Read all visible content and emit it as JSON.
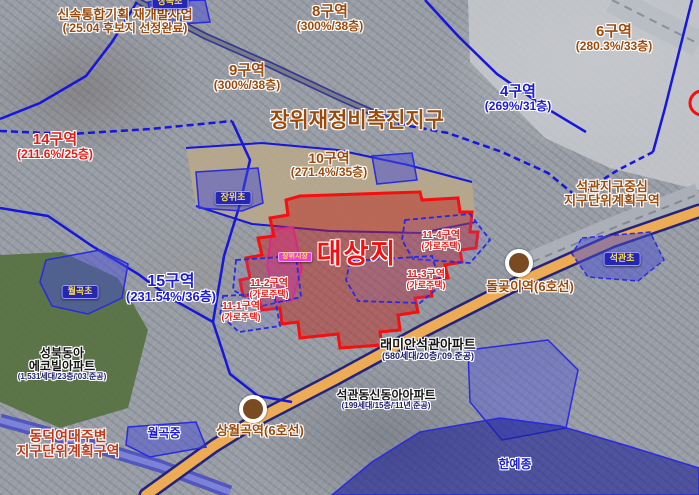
{
  "map": {
    "district_title": "장위재정비촉진지구",
    "colors": {
      "label-brown": "#9c4a0a",
      "label-red": "#e51c15",
      "label-redbrown": "#c0391a",
      "label-blue": "#1b1bd8",
      "label-black": "#141414",
      "label-navy": "#1a1a72",
      "target-red": "#f50f0f",
      "boundary-blue": "#1616dc",
      "road-orange": "#edab55",
      "road-casing": "#23237d",
      "railway-gray": "#b4b8bf",
      "schoolbox-bg": "#2626b4",
      "schoolbox-text": "#ffe14d",
      "market-magenta": "#e83cdc",
      "station-brown": "#7a4b22"
    },
    "labels": [
      {
        "id": "fast-track-note",
        "x": 125,
        "y": 8,
        "cls": "c-brown",
        "lines": [
          {
            "t": "신속통합기획 재개발사업",
            "fs": 13
          },
          {
            "t": "('25.04 후보지 선정완료)",
            "fs": 12
          }
        ]
      },
      {
        "id": "zone-8-label",
        "x": 330,
        "y": 4,
        "cls": "c-brown",
        "lines": [
          {
            "t": "8구역",
            "fs": 15
          },
          {
            "t": "(300%/38층)",
            "fs": 12
          }
        ]
      },
      {
        "id": "zone-9-label",
        "x": 247,
        "y": 63,
        "cls": "c-brown",
        "lines": [
          {
            "t": "9구역",
            "fs": 15
          },
          {
            "t": "(300%/38층)",
            "fs": 12
          }
        ]
      },
      {
        "id": "zone-6-label",
        "x": 614,
        "y": 24,
        "cls": "c-brown",
        "lines": [
          {
            "t": "6구역",
            "fs": 15
          },
          {
            "t": "(280.3%/33층)",
            "fs": 12
          }
        ]
      },
      {
        "id": "zone-4-label",
        "x": 518,
        "y": 84,
        "cls": "c-blue",
        "lines": [
          {
            "t": "4구역",
            "fs": 15
          },
          {
            "t": "(269%/31층)",
            "fs": 12
          }
        ]
      },
      {
        "id": "district-title",
        "x": 357,
        "y": 110,
        "cls": "c-brown",
        "lines": [
          {
            "t": "장위재정비촉진지구",
            "fs": 21
          }
        ]
      },
      {
        "id": "zone-10-label",
        "x": 329,
        "y": 151,
        "cls": "c-brown",
        "lines": [
          {
            "t": "10구역",
            "fs": 14
          },
          {
            "t": "(271.4%/35층)",
            "fs": 12
          }
        ]
      },
      {
        "id": "zone-14-label",
        "x": 55,
        "y": 132,
        "cls": "c-red",
        "lines": [
          {
            "t": "14구역",
            "fs": 15
          },
          {
            "t": "(211.6%/25층)",
            "fs": 12
          }
        ]
      },
      {
        "id": "seokgwan-district-center-label",
        "x": 612,
        "y": 180,
        "cls": "c-brown",
        "lines": [
          {
            "t": "석관지구중심",
            "fs": 13
          },
          {
            "t": "지구단위계획구역",
            "fs": 13
          }
        ]
      },
      {
        "id": "target-site-label",
        "x": 357,
        "y": 240,
        "cls": "c-target",
        "lines": [
          {
            "t": "대상지",
            "fs": 27
          }
        ]
      },
      {
        "id": "zone-11-4-label",
        "x": 441,
        "y": 231,
        "cls": "c-red",
        "lines": [
          {
            "t": "11-4구역",
            "fs": 10
          },
          {
            "t": "(가로주택)",
            "fs": 9
          }
        ]
      },
      {
        "id": "zone-11-3-label",
        "x": 426,
        "y": 270,
        "cls": "c-red",
        "lines": [
          {
            "t": "11-3구역",
            "fs": 10
          },
          {
            "t": "(가로주택)",
            "fs": 9
          }
        ]
      },
      {
        "id": "zone-11-2-label",
        "x": 269,
        "y": 279,
        "cls": "c-red",
        "lines": [
          {
            "t": "11-2구역",
            "fs": 10
          },
          {
            "t": "(가로주택)",
            "fs": 9
          }
        ]
      },
      {
        "id": "zone-11-1-label",
        "x": 241,
        "y": 302,
        "cls": "c-red",
        "lines": [
          {
            "t": "11-1구역",
            "fs": 10
          },
          {
            "t": "(가로주택)",
            "fs": 9
          }
        ]
      },
      {
        "id": "zone-15-label",
        "x": 171,
        "y": 273,
        "cls": "c-blue",
        "lines": [
          {
            "t": "15구역",
            "fs": 16
          },
          {
            "t": "(231.54%/36층)",
            "fs": 13
          }
        ]
      },
      {
        "id": "apt-seongbuk-dongah-label",
        "x": 62,
        "y": 347,
        "cls": "c-black",
        "lines": [
          {
            "t": "성북동아",
            "fs": 12
          },
          {
            "t": "에코빌아파트",
            "fs": 12
          },
          {
            "t": "(1,531세대/23층/'03.준공)",
            "fs": 8,
            "cls": "c-navy"
          }
        ]
      },
      {
        "id": "apt-raemian-seokgwan-label",
        "x": 428,
        "y": 338,
        "cls": "c-black",
        "lines": [
          {
            "t": "래미안석관아파트",
            "fs": 13
          },
          {
            "t": "(580세대/20층/'09.준공)",
            "fs": 9,
            "cls": "c-navy"
          }
        ]
      },
      {
        "id": "apt-seokgwan-dongah-label",
        "x": 386,
        "y": 389,
        "cls": "c-black",
        "lines": [
          {
            "t": "석관동신동아아파트",
            "fs": 12
          },
          {
            "t": "(199세대/15층/'11년 준공)",
            "fs": 8,
            "cls": "c-navy"
          }
        ]
      },
      {
        "id": "station-dolgoji-label",
        "x": 530,
        "y": 280,
        "cls": "c-brown",
        "lines": [
          {
            "t": "돌곶이역(6호선)",
            "fs": 13
          }
        ]
      },
      {
        "id": "station-sangwolgok-label",
        "x": 260,
        "y": 424,
        "cls": "c-brown",
        "lines": [
          {
            "t": "상월곡역(6호선)",
            "fs": 13
          }
        ]
      },
      {
        "id": "dongduk-district-label",
        "x": 68,
        "y": 429,
        "cls": "c-redbrown",
        "lines": [
          {
            "t": "동덕여대주변",
            "fs": 14
          },
          {
            "t": "지구단위계획구역",
            "fs": 14
          }
        ]
      },
      {
        "id": "wolgok-middle-label",
        "x": 164,
        "y": 427,
        "cls": "c-blue",
        "lines": [
          {
            "t": "월곡중",
            "fs": 12
          }
        ]
      },
      {
        "id": "hanyejong-label",
        "x": 515,
        "y": 458,
        "cls": "c-blue",
        "lines": [
          {
            "t": "한예종",
            "fs": 12
          }
        ]
      }
    ],
    "school_boxes": [
      {
        "id": "school-janggok-box",
        "x": 170,
        "y": -5,
        "text": "장곡초",
        "fs": 9
      },
      {
        "id": "school-jangwi-box",
        "x": 233,
        "y": 191,
        "text": "장위초",
        "fs": 9
      },
      {
        "id": "school-wolgok-elem-box",
        "x": 80,
        "y": 285,
        "text": "월곡초",
        "fs": 9
      },
      {
        "id": "school-seokgwan-box",
        "x": 622,
        "y": 252,
        "text": "석관초",
        "fs": 9
      }
    ],
    "market_box": {
      "id": "market-jangwi-box",
      "x": 295,
      "y": 252,
      "text": "장위시장",
      "fs": 7
    },
    "stations": [
      {
        "id": "station-dolgoji-marker",
        "x": 519,
        "y": 263
      },
      {
        "id": "station-sangwolgok-marker",
        "x": 253,
        "y": 409
      }
    ]
  }
}
